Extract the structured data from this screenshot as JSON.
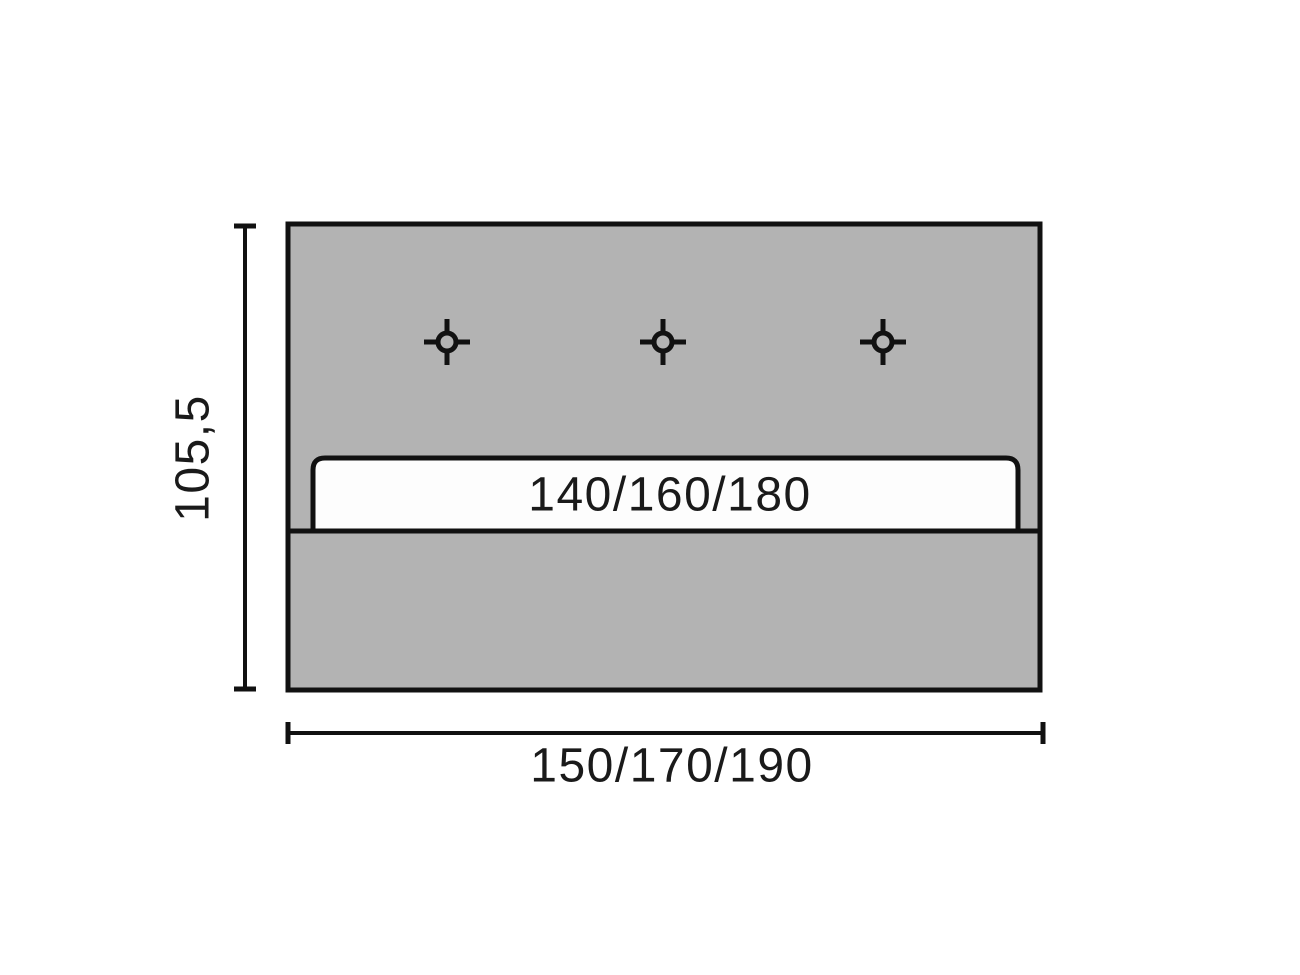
{
  "colors": {
    "panel_fill": "#b3b3b3",
    "outline": "#111111",
    "slot_fill": "#fdfdfd",
    "text": "#1a1a1a",
    "background": "#ffffff"
  },
  "diagram": {
    "height_dimension_label": "105,5",
    "width_dimension_label": "150/170/190",
    "slot_width_label": "140/160/180",
    "marker_icon": "crosshair-drill-hole",
    "marker_count": 3
  }
}
